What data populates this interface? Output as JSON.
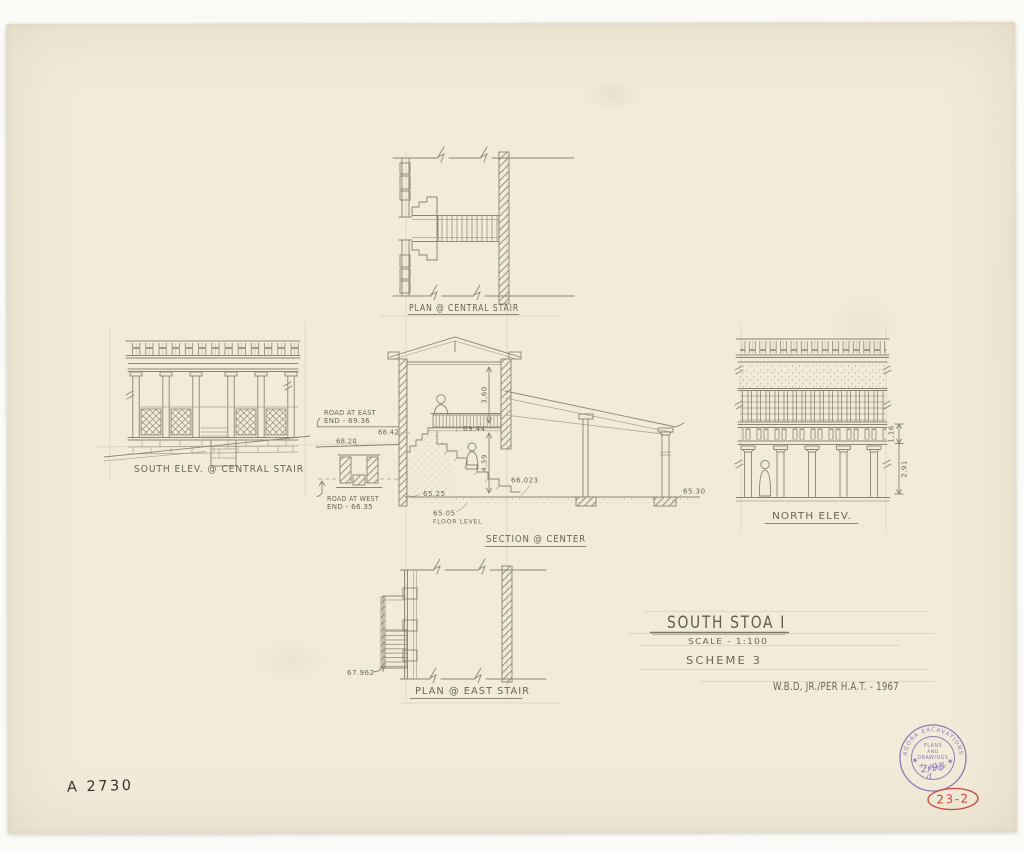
{
  "sheet": {
    "drawing_number": "A 2730",
    "red_inventory_number": "23-2"
  },
  "title_block": {
    "title": "SOUTH STOA I",
    "scale": "SCALE - 1:100",
    "scheme": "SCHEME 3",
    "credit": "W.B.D, JR./PER H.A.T. - 1967"
  },
  "views": {
    "plan_central_stair": {
      "label": "PLAN @ CENTRAL STAIR"
    },
    "south_elevation": {
      "label": "SOUTH ELEV. @ CENTRAL STAIR"
    },
    "section_center": {
      "label": "SECTION @ CENTER",
      "annotations": {
        "road_east_line1": "ROAD AT EAST",
        "road_east_line2": "END - 69.36",
        "road_west_line1": "ROAD AT WEST",
        "road_west_line2": "END - 66.35",
        "level_68_20": "68.20",
        "level_68_42": "68.42",
        "level_69_44": "69.44",
        "level_66_023": "66.023",
        "level_65_25": "65.25",
        "level_65_05": "65.05",
        "floor_level_caption": "FLOOR LEVEL",
        "level_65_30": "65.30",
        "dim_upper": "3,60",
        "dim_lower": "4,39"
      }
    },
    "north_elevation": {
      "label": "NORTH ELEV.",
      "dim_upper": "1,16",
      "dim_lower": "2,91"
    },
    "plan_east_stair": {
      "label": "PLAN @ EAST STAIR",
      "level_67_962": "67.962"
    }
  },
  "stamp": {
    "arc_top": "AGORA EXCAVATIONS",
    "arc_bottom": "✱ ATHENS ✱",
    "center_line1": "PLANS",
    "center_line2": "AND",
    "center_line3": "DRAWINGS",
    "number": "2/95",
    "letter": "d"
  }
}
